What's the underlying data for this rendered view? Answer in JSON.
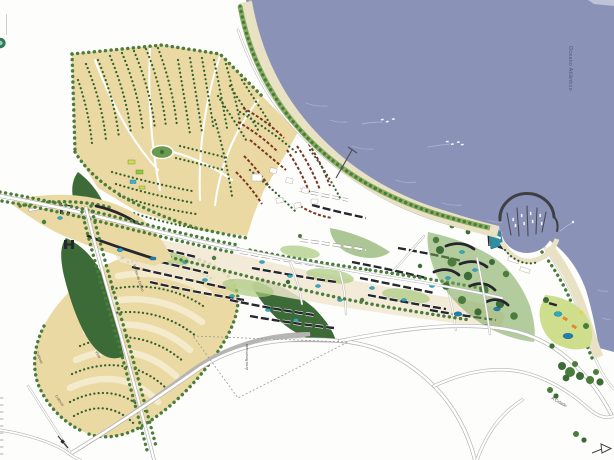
{
  "labels": {
    "ocean": "Oceano Atlântico",
    "nucleo_cultivo": "Núcleo de Cultivo",
    "vilas": "Vilas",
    "cultivos_west": "Cultivos",
    "cultivos_south": "Cultivos",
    "area_reservada": "Área Reservada",
    "road_to_city": "A Cidade"
  },
  "colors": {
    "paper": "#fdfdfb",
    "sea": "#8a92b8",
    "wave": "#aab2cf",
    "wet": "#b7bed8",
    "sand": "#e9e1c3",
    "dune": "#8aae62",
    "field": "#ead9a3",
    "field_light": "#f3ebcb",
    "tree": "#4a7c3c",
    "tree_dark": "#33602d",
    "forest": "#3c6b37",
    "road_casing": "#b5b5b3",
    "road_fill": "#ffffff",
    "building": "#26262e",
    "red_roof": "#7c3424",
    "pool": "#2ea8c4",
    "lagoon": "#1f7fae",
    "lawn": "#cede8d",
    "orange": "#e08a2c",
    "yellow": "#e6d44e",
    "teal_building": "#2d8fa0",
    "breakwater": "#3f3f46",
    "label": "#5b5244",
    "label_water": "#4e5478",
    "label_gray": "#6a6a6a"
  }
}
